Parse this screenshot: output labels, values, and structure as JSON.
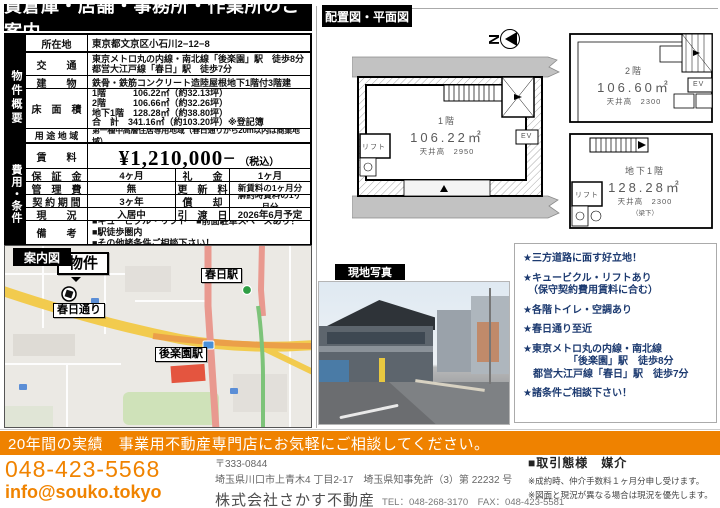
{
  "title": "貸倉庫・店舗・事務所・作業所のご案内",
  "sections": {
    "plan_header": "配置図・平面図",
    "photo_header": "現地写真",
    "map_header": "案内図"
  },
  "location": {
    "label": "所在地",
    "value": "東京都文京区小石川2−12−8"
  },
  "overview": {
    "label": "物件概要",
    "transport": {
      "label": "交　　通",
      "lines": [
        "東京メトロ丸の内線・南北線「後楽園」駅　徒歩8分",
        "都営大江戸線「春日」駅　徒歩7分"
      ]
    },
    "building": {
      "label": "建　　物",
      "value": "鉄骨・鉄筋コンクリート造陸屋根地下1階付3階建"
    },
    "floor_area": {
      "label": "床　面　積",
      "lines": [
        "1階　　　106.22㎡（約32.13坪）",
        "2階　　　106.66㎡（約32.26坪）",
        "地下1階　128.28㎡（約38.80坪）",
        "合　計　341.16㎡（約103.20坪）※登記簿"
      ]
    },
    "zoning": {
      "label": "用 途 地 域",
      "value": "第一種中高層住居専用地域（春日通りから20m以内は商業地域）"
    }
  },
  "costs": {
    "label": "費用・条件",
    "rent": {
      "label": "賃　　料",
      "value": "¥1,210,000−",
      "tax": "（税込）"
    },
    "rows": [
      {
        "l1": "保　証　金",
        "v1": "4ヶ月",
        "l2": "礼　　金",
        "v2": "1ヶ月"
      },
      {
        "l1": "管　理　費",
        "v1": "無",
        "l2": "更　新　料",
        "v2": "新賃料の1ヶ月分"
      },
      {
        "l1": "契 約 期 間",
        "v1": "3ヶ年",
        "l2": "償　　却",
        "v2": "解約時賃料の1ヶ月分"
      },
      {
        "l1": "現　　況",
        "v1": "入居中",
        "l2": "引　渡　日",
        "v2": "2026年6月予定"
      }
    ],
    "notes": {
      "label": "備　　考",
      "lines": [
        "■キュービクル・リフト　■前面駐車スペースあり！　■駅徒歩圏内",
        "■その他諸条件ご相談下さい！"
      ]
    }
  },
  "map": {
    "property": "物件",
    "kasuga_street": "春日通り",
    "kasuga_station": "春日駅",
    "korakuen_station": "後楽園駅"
  },
  "plan": {
    "compass": "N",
    "f1": {
      "name": "1階",
      "area": "106.22㎡",
      "ceiling": "天井高　2950",
      "lift": "リフト",
      "ev": "EV"
    },
    "f2": {
      "name": "2階",
      "area": "106.60㎡",
      "ceiling": "天井高　2300",
      "ev": "EV"
    },
    "b1": {
      "name": "地下1階",
      "area": "128.28㎡",
      "ceiling": "天井高　2300",
      "ceiling_sub": "（梁下）",
      "lift": "リフト"
    }
  },
  "highlights": {
    "items": [
      {
        "lines": [
          "★三方道路に面す好立地！"
        ]
      },
      {
        "lines": [
          "★キュービクル・リフトあり",
          "　（保守契約費用賃料に合む）"
        ]
      },
      {
        "lines": [
          "★各階トイレ・空調あり"
        ]
      },
      {
        "lines": [
          "★春日通り至近"
        ]
      },
      {
        "lines": [
          "★東京メトロ丸の内線・南北線",
          "　　　　　「後楽園」駅　徒歩8分",
          "　都営大江戸線「春日」駅　徒歩7分"
        ]
      },
      {
        "lines": [
          "★諸条件ご相談下さい！"
        ]
      }
    ]
  },
  "footer": {
    "banner": "20年間の実績　事業用不動産専門店にお気軽にご相談してください。",
    "phone": "048-423-5568",
    "email": "info@souko.tokyo",
    "postal": "〒333-0844",
    "address": "埼玉県川口市上青木4 丁目2-17　埼玉県知事免許（3）第 22232 号",
    "company": "株式会社さかす不動産",
    "telfax": "TEL：048-268-3170　FAX：048-423-5581",
    "deal": "■取引態様　媒介",
    "note1": "※成約時、仲介手数料１ヶ月分申し受けます。",
    "note2": "※図面と現況が異なる場合は現況を優先します。"
  },
  "colors": {
    "accent_orange": "#ef8200",
    "highlight_navy": "#1c3a70",
    "header_black": "#000000"
  }
}
